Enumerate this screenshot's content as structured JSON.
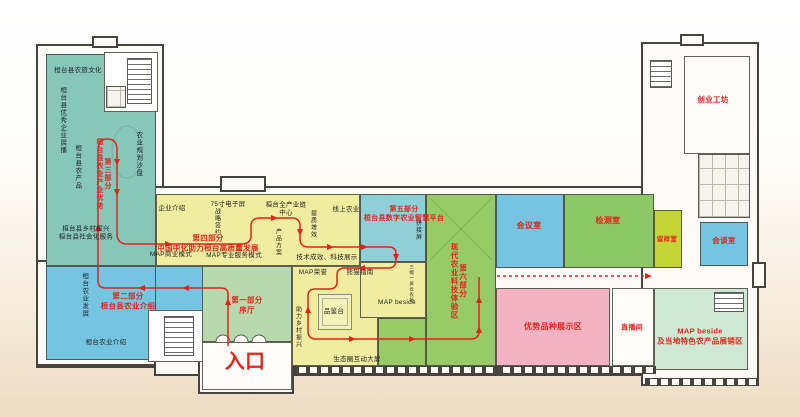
{
  "palette": {
    "wall": "#45443e",
    "route_red": "#e0241b",
    "teal": "#87c7ba",
    "yellow": "#f1eda0",
    "blue_zone": "#74c4e2",
    "hall_green": "#b8d9ad",
    "exp_green": "#96cb66",
    "cyan": "#8fd0d8",
    "test_green": "#8cc966",
    "sample_yellow": "#c5d634",
    "pink": "#f3b3c2",
    "shop_green": "#cfe8d4"
  },
  "entrance_label": "入口",
  "sections": [
    {
      "title": "第一部分",
      "subtitle": "序厅"
    },
    {
      "title": "第二部分",
      "subtitle": "桓台县农业介绍"
    },
    {
      "title": "第三部分",
      "subtitle": "桓台县农业产业优势"
    },
    {
      "title": "第四部分",
      "subtitle": "中国中化助力桓台高质量发展"
    },
    {
      "title": "第五部分",
      "subtitle": "桓台县数字农业智慧平台"
    },
    {
      "title": "第六部分",
      "subtitle": "现代农业科技体验区"
    }
  ],
  "zones": [
    {
      "id": "culture-teal",
      "x": 46,
      "y": 54,
      "w": 110,
      "h": 212,
      "color": "#87c7ba"
    },
    {
      "id": "stair-room-top",
      "x": 104,
      "y": 52,
      "w": 54,
      "h": 60,
      "color": "#ffffff"
    },
    {
      "id": "agri-intro-blue",
      "x": 46,
      "y": 266,
      "w": 110,
      "h": 94,
      "color": "#74c4e2"
    },
    {
      "id": "agri-intro-blue-ext",
      "x": 155,
      "y": 266,
      "w": 49,
      "h": 46,
      "color": "#74c4e2"
    },
    {
      "id": "stair-room-bottom",
      "x": 148,
      "y": 310,
      "w": 56,
      "h": 52,
      "color": "#ffffff"
    },
    {
      "id": "lobby-hall",
      "x": 202,
      "y": 266,
      "w": 90,
      "h": 76,
      "color": "#b8d9ad"
    },
    {
      "id": "vestibule",
      "x": 202,
      "y": 342,
      "w": 90,
      "h": 48,
      "color": "#fdfcf8"
    },
    {
      "id": "yellow-top-band",
      "x": 156,
      "y": 194,
      "w": 204,
      "h": 72,
      "color": "#f1eda0"
    },
    {
      "id": "yellow-center",
      "x": 292,
      "y": 266,
      "w": 86,
      "h": 100,
      "color": "#f1eda0"
    },
    {
      "id": "smart-agri-cyan",
      "x": 360,
      "y": 194,
      "w": 66,
      "h": 68,
      "color": "#8fd0d8"
    },
    {
      "id": "map-beside-yellow",
      "x": 360,
      "y": 262,
      "w": 66,
      "h": 56,
      "color": "#f1eda0"
    },
    {
      "id": "experience-green",
      "x": 426,
      "y": 194,
      "w": 70,
      "h": 172,
      "color": "#96cb66"
    },
    {
      "id": "experience-green-ext",
      "x": 378,
      "y": 318,
      "w": 48,
      "h": 48,
      "color": "#96cb66"
    },
    {
      "id": "meeting-room",
      "x": 496,
      "y": 194,
      "w": 68,
      "h": 74,
      "color": "#74c4e2"
    },
    {
      "id": "testing-room",
      "x": 564,
      "y": 194,
      "w": 90,
      "h": 74,
      "color": "#8cc966"
    },
    {
      "id": "sample-room",
      "x": 654,
      "y": 210,
      "w": 28,
      "h": 58,
      "color": "#c5d634"
    },
    {
      "id": "talk-room",
      "x": 700,
      "y": 222,
      "w": 48,
      "h": 44,
      "color": "#74c4e2"
    },
    {
      "id": "variety-room",
      "x": 496,
      "y": 288,
      "w": 114,
      "h": 78,
      "color": "#f3b3c2"
    },
    {
      "id": "live-room",
      "x": 612,
      "y": 288,
      "w": 42,
      "h": 78,
      "color": "#fdfcf8"
    },
    {
      "id": "map-shop-zone",
      "x": 654,
      "y": 288,
      "w": 94,
      "h": 82,
      "color": "#cfe8d4"
    },
    {
      "id": "startup-room",
      "x": 684,
      "y": 56,
      "w": 66,
      "h": 98,
      "color": "#fdfcf8"
    }
  ],
  "labels": [
    {
      "id": "label-culture",
      "text": "桓台县农旅文化",
      "x": 78,
      "y": 71
    },
    {
      "id": "label-excellent-enterprise",
      "text": "桓台县优秀企业展播",
      "x": 62,
      "y": 120,
      "v": true
    },
    {
      "id": "label-agri-product",
      "text": "桓台县农产品",
      "x": 77,
      "y": 167,
      "v": true
    },
    {
      "id": "label-sand-table",
      "text": "农业规划沙盘",
      "x": 138,
      "y": 154,
      "v": true
    },
    {
      "id": "label-rural-service",
      "text": "桓台县乡村振兴\n桓台县社会化服务",
      "x": 86,
      "y": 234
    },
    {
      "id": "label-agri-develop",
      "text": "桓台农业发展",
      "x": 84,
      "y": 295,
      "v": true
    },
    {
      "id": "label-agri-intro",
      "text": "桓台农业介绍",
      "x": 106,
      "y": 343
    },
    {
      "id": "label-part3",
      "text": "第三部分\n桓台县农业产业优势",
      "x": 103,
      "y": 174,
      "v": true,
      "red": true,
      "bold": true,
      "size": 7
    },
    {
      "id": "label-part2",
      "text": "第二部分\n桓台县农业介绍",
      "x": 128,
      "y": 301,
      "red": true,
      "bold": true,
      "size": 7.5
    },
    {
      "id": "label-part1",
      "text": "第一部分\n序厅",
      "x": 247,
      "y": 305,
      "red": true,
      "bold": true,
      "size": 7.5
    },
    {
      "id": "label-part4",
      "text": "第四部分\n中国中化助力桓台高质量发展",
      "x": 208,
      "y": 243,
      "red": true,
      "bold": true,
      "size": 7.5
    },
    {
      "id": "label-part5",
      "text": "第五部分\n桓台县数字农业智慧平台",
      "x": 404,
      "y": 214,
      "red": true,
      "bold": true,
      "size": 7
    },
    {
      "id": "label-part6",
      "text": "第六部分\n现代农业科技体验区",
      "x": 458,
      "y": 281,
      "v": true,
      "red": true,
      "bold": true,
      "size": 7.5
    },
    {
      "id": "label-entrance",
      "text": "入口",
      "x": 245,
      "y": 362,
      "red": true,
      "bold": true,
      "size": 20
    },
    {
      "id": "label-enterprise-intro",
      "text": "企业介绍",
      "x": 172,
      "y": 209
    },
    {
      "id": "label-75-screen",
      "text": "75寸电子屏",
      "x": 228,
      "y": 205
    },
    {
      "id": "label-strategic-signing",
      "text": "战略签约",
      "x": 216,
      "y": 222,
      "v": true,
      "size": 6
    },
    {
      "id": "label-industry-chain",
      "text": "桓台全产业链\n中心",
      "x": 286,
      "y": 210
    },
    {
      "id": "label-product-plan",
      "text": "产品方案",
      "x": 277,
      "y": 242,
      "v": true,
      "size": 6
    },
    {
      "id": "label-quality",
      "text": "提质增效",
      "x": 312,
      "y": 224,
      "v": true,
      "size": 6
    },
    {
      "id": "label-online-agri",
      "text": "线上农业",
      "x": 346,
      "y": 210
    },
    {
      "id": "label-map-business",
      "text": "MAP商业模式",
      "x": 171,
      "y": 255
    },
    {
      "id": "label-map-professional",
      "text": "MAP专业服务模式",
      "x": 234,
      "y": 256
    },
    {
      "id": "label-tech-achievement",
      "text": "技术成效、科技展示",
      "x": 327,
      "y": 258
    },
    {
      "id": "label-map-honor",
      "text": "MAP荣誉",
      "x": 313,
      "y": 273
    },
    {
      "id": "label-panda-guide",
      "text": "熊猫指南",
      "x": 360,
      "y": 273
    },
    {
      "id": "label-tasting-table",
      "text": "品鉴台",
      "x": 334,
      "y": 312,
      "size": 6.5
    },
    {
      "id": "label-rural-help",
      "text": "助力乡村振兴",
      "x": 297,
      "y": 327,
      "v": true,
      "size": 6
    },
    {
      "id": "label-map-beside-block",
      "text": "MAP beside",
      "x": 397,
      "y": 303,
      "size": 6.5
    },
    {
      "id": "label-mini-note",
      "text": "三端一屏云农场",
      "x": 412,
      "y": 284,
      "v": true,
      "size": 4.5
    },
    {
      "id": "label-eco-screen",
      "text": "生态圈互动大屏",
      "x": 357,
      "y": 360,
      "size": 6.5
    },
    {
      "id": "label-splice-screen",
      "text": "拼接屏",
      "x": 417,
      "y": 230,
      "v": true,
      "size": 6
    },
    {
      "id": "label-meeting-room",
      "text": "会议室",
      "x": 529,
      "y": 226,
      "red": true,
      "bold": true,
      "size": 8
    },
    {
      "id": "label-testing-room",
      "text": "检测室",
      "x": 608,
      "y": 221,
      "red": true,
      "bold": true,
      "size": 8
    },
    {
      "id": "label-sample-room",
      "text": "留样室",
      "x": 667,
      "y": 240,
      "red": true,
      "bold": true,
      "size": 6.5
    },
    {
      "id": "label-talk-room",
      "text": "会谈室",
      "x": 724,
      "y": 241,
      "red": true,
      "bold": true,
      "size": 7.5
    },
    {
      "id": "label-startup-workshop",
      "text": "创业工坊",
      "x": 713,
      "y": 100,
      "red": true,
      "bold": true,
      "size": 7.5
    },
    {
      "id": "label-variety-zone",
      "text": "优势品种展示区",
      "x": 553,
      "y": 327,
      "red": true,
      "bold": true,
      "size": 8
    },
    {
      "id": "label-live-room",
      "text": "直播间",
      "x": 632,
      "y": 328,
      "red": true,
      "bold": true,
      "size": 7
    },
    {
      "id": "label-map-shop",
      "text": "MAP beside\n及当地特色农产品展销区",
      "x": 700,
      "y": 336,
      "red": true,
      "bold": true,
      "size": 7.5
    }
  ]
}
